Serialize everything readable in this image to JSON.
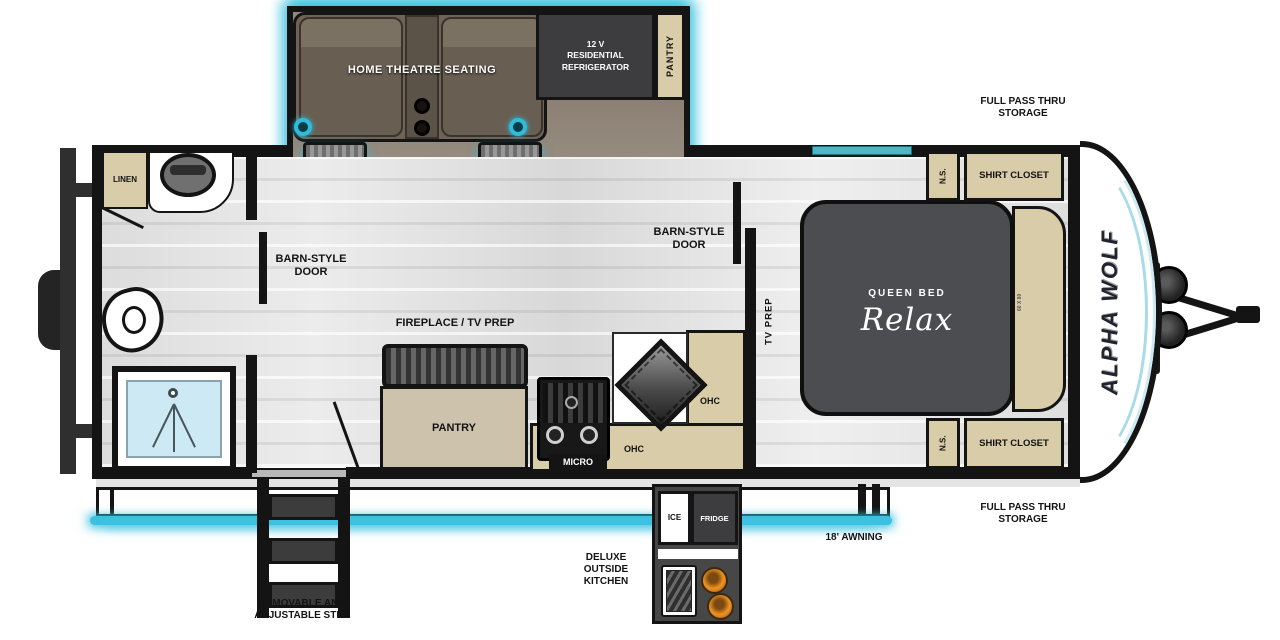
{
  "title": "Alpha Wolf travel trailer floor plan",
  "colors": {
    "accent_cyan": "#3cc2e0",
    "cabinet_tan": "#d9cca9",
    "appliance_dark": "#3d3c3e",
    "seat_brown": "#6e6356",
    "bed_gray": "#4b4d50",
    "burner_orange": "#ef9322",
    "shower_blue": "#cde9f3"
  },
  "slide_out": {
    "theatre_label": "HOME THEATRE SEATING",
    "fridge_label": "12 V\nRESIDENTIAL\nREFRIGERATOR",
    "pantry_label": "PANTRY"
  },
  "bathroom": {
    "linen_label": "LINEN"
  },
  "living": {
    "barn_door_rear": "BARN-STYLE\nDOOR",
    "barn_door_front": "BARN-STYLE\nDOOR",
    "fireplace_label": "FIREPLACE / TV PREP",
    "pantry_label": "PANTRY",
    "micro_label": "MICRO",
    "ohc_label_1": "OHC",
    "ohc_label_2": "OHC",
    "tv_prep_label": "TV PREP"
  },
  "bedroom": {
    "bed_type": "QUEEN BED",
    "bed_brand": "Relax",
    "bed_size": "60 X 80",
    "nightstand_top": "N.S.",
    "nightstand_bottom": "N.S.",
    "shirt_closet_top": "SHIRT CLOSET",
    "shirt_closet_bottom": "SHIRT CLOSET"
  },
  "exterior": {
    "brand": "ALPHA WOLF",
    "storage_top": "FULL PASS THRU\nSTORAGE",
    "storage_bottom": "FULL PASS THRU\nSTORAGE",
    "awning_label": "18' AWNING",
    "step_label": "REMOVABLE AND\nADJUSTABLE STEP",
    "outside_kitchen_label": "DELUXE\nOUTSIDE\nKITCHEN",
    "ice_label": "ICE",
    "fridge_label": "FRIDGE"
  }
}
